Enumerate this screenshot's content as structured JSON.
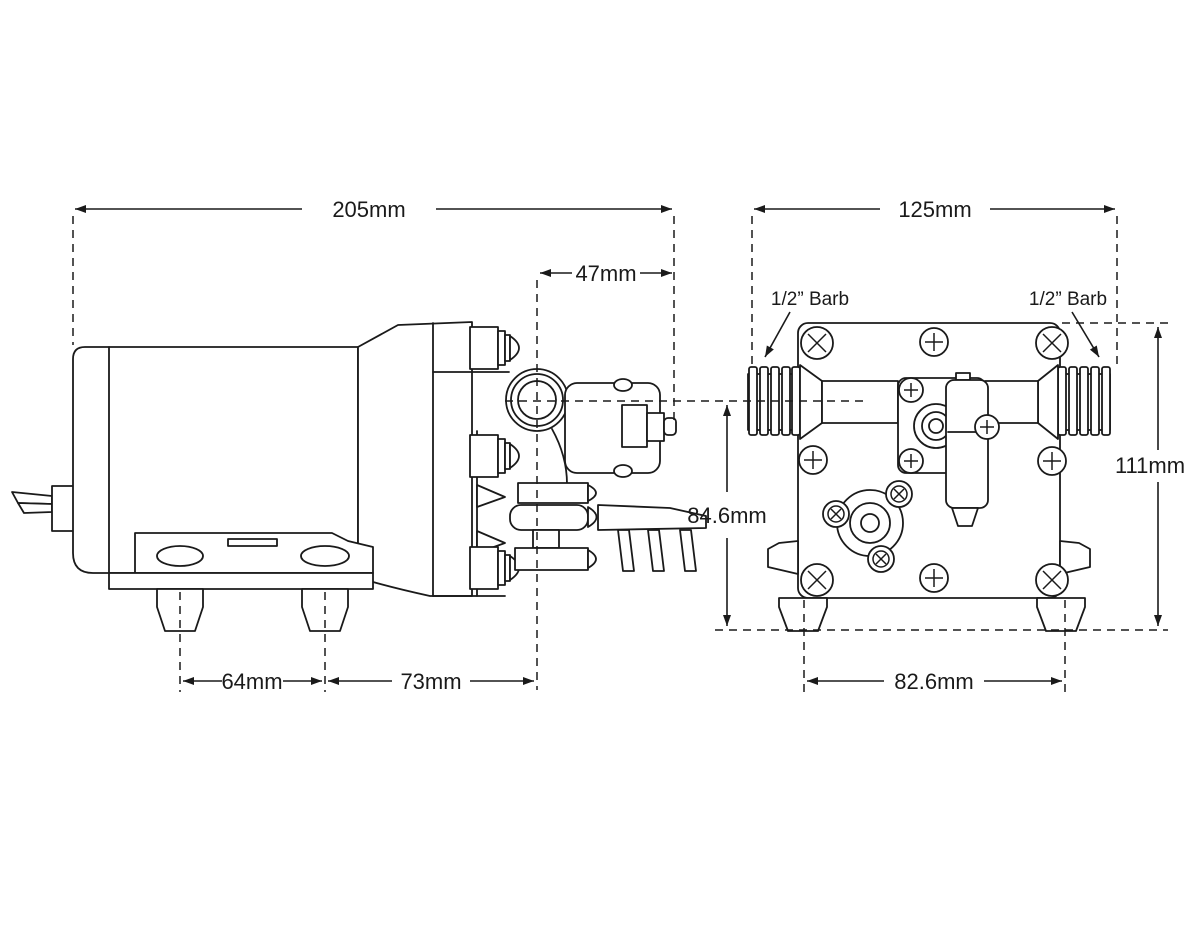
{
  "diagram": {
    "type": "technical-dimension-drawing",
    "subject": "Diaphragm pump — side view and bottom view with dimensions",
    "line_color": "#1a1a1a",
    "background_color": "#ffffff",
    "side_view": {
      "name": "side-view",
      "dim_overall_length": "205mm",
      "dim_head_length": "47mm",
      "dim_foot_spacing": "64mm",
      "dim_foot_to_port": "73mm",
      "dim_centerline_to_base": "84.6mm"
    },
    "bottom_view": {
      "name": "bottom-view",
      "dim_overall_width": "125mm",
      "dim_overall_height": "111mm",
      "dim_foot_spacing": "82.6mm",
      "port_left_label": "1/2” Barb",
      "port_right_label": "1/2” Barb"
    }
  }
}
